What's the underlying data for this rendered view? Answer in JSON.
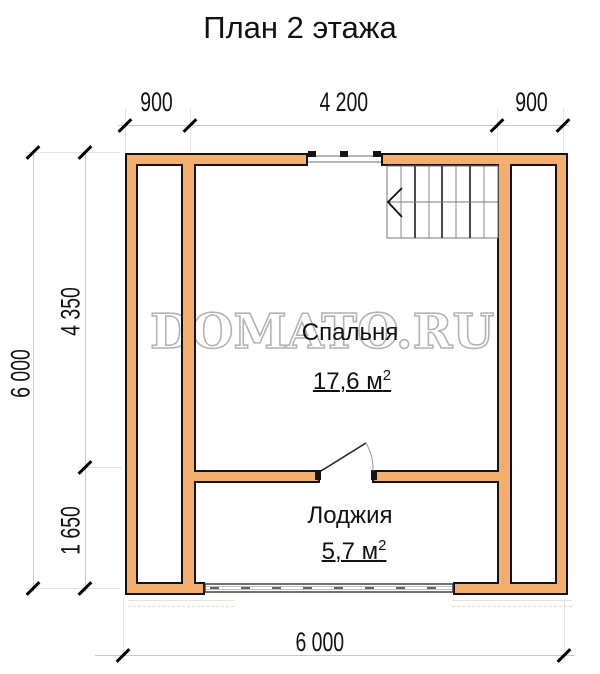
{
  "title": "План 2 этажа",
  "watermark": "DOMATO.RU",
  "dimensions": {
    "top_left": "900",
    "top_mid": "4 200",
    "top_right": "900",
    "side_outer": "6 000",
    "side_upper": "4 350",
    "side_lower": "1 650",
    "bottom": "6 000"
  },
  "rooms": {
    "bedroom": {
      "name": "Спальня",
      "area": "17,6 м",
      "area_exp": "2"
    },
    "loggia": {
      "name": "Лоджия",
      "area": "5,7 м",
      "area_exp": "2"
    }
  },
  "colors": {
    "wall_fill": "#F6AE6C",
    "wall_outline": "#131313",
    "dimension_line": "#c9c9c9",
    "tick": "#000000",
    "text": "#111111",
    "watermark_stroke": "#b3b3b3",
    "stair_line": "#777777"
  }
}
